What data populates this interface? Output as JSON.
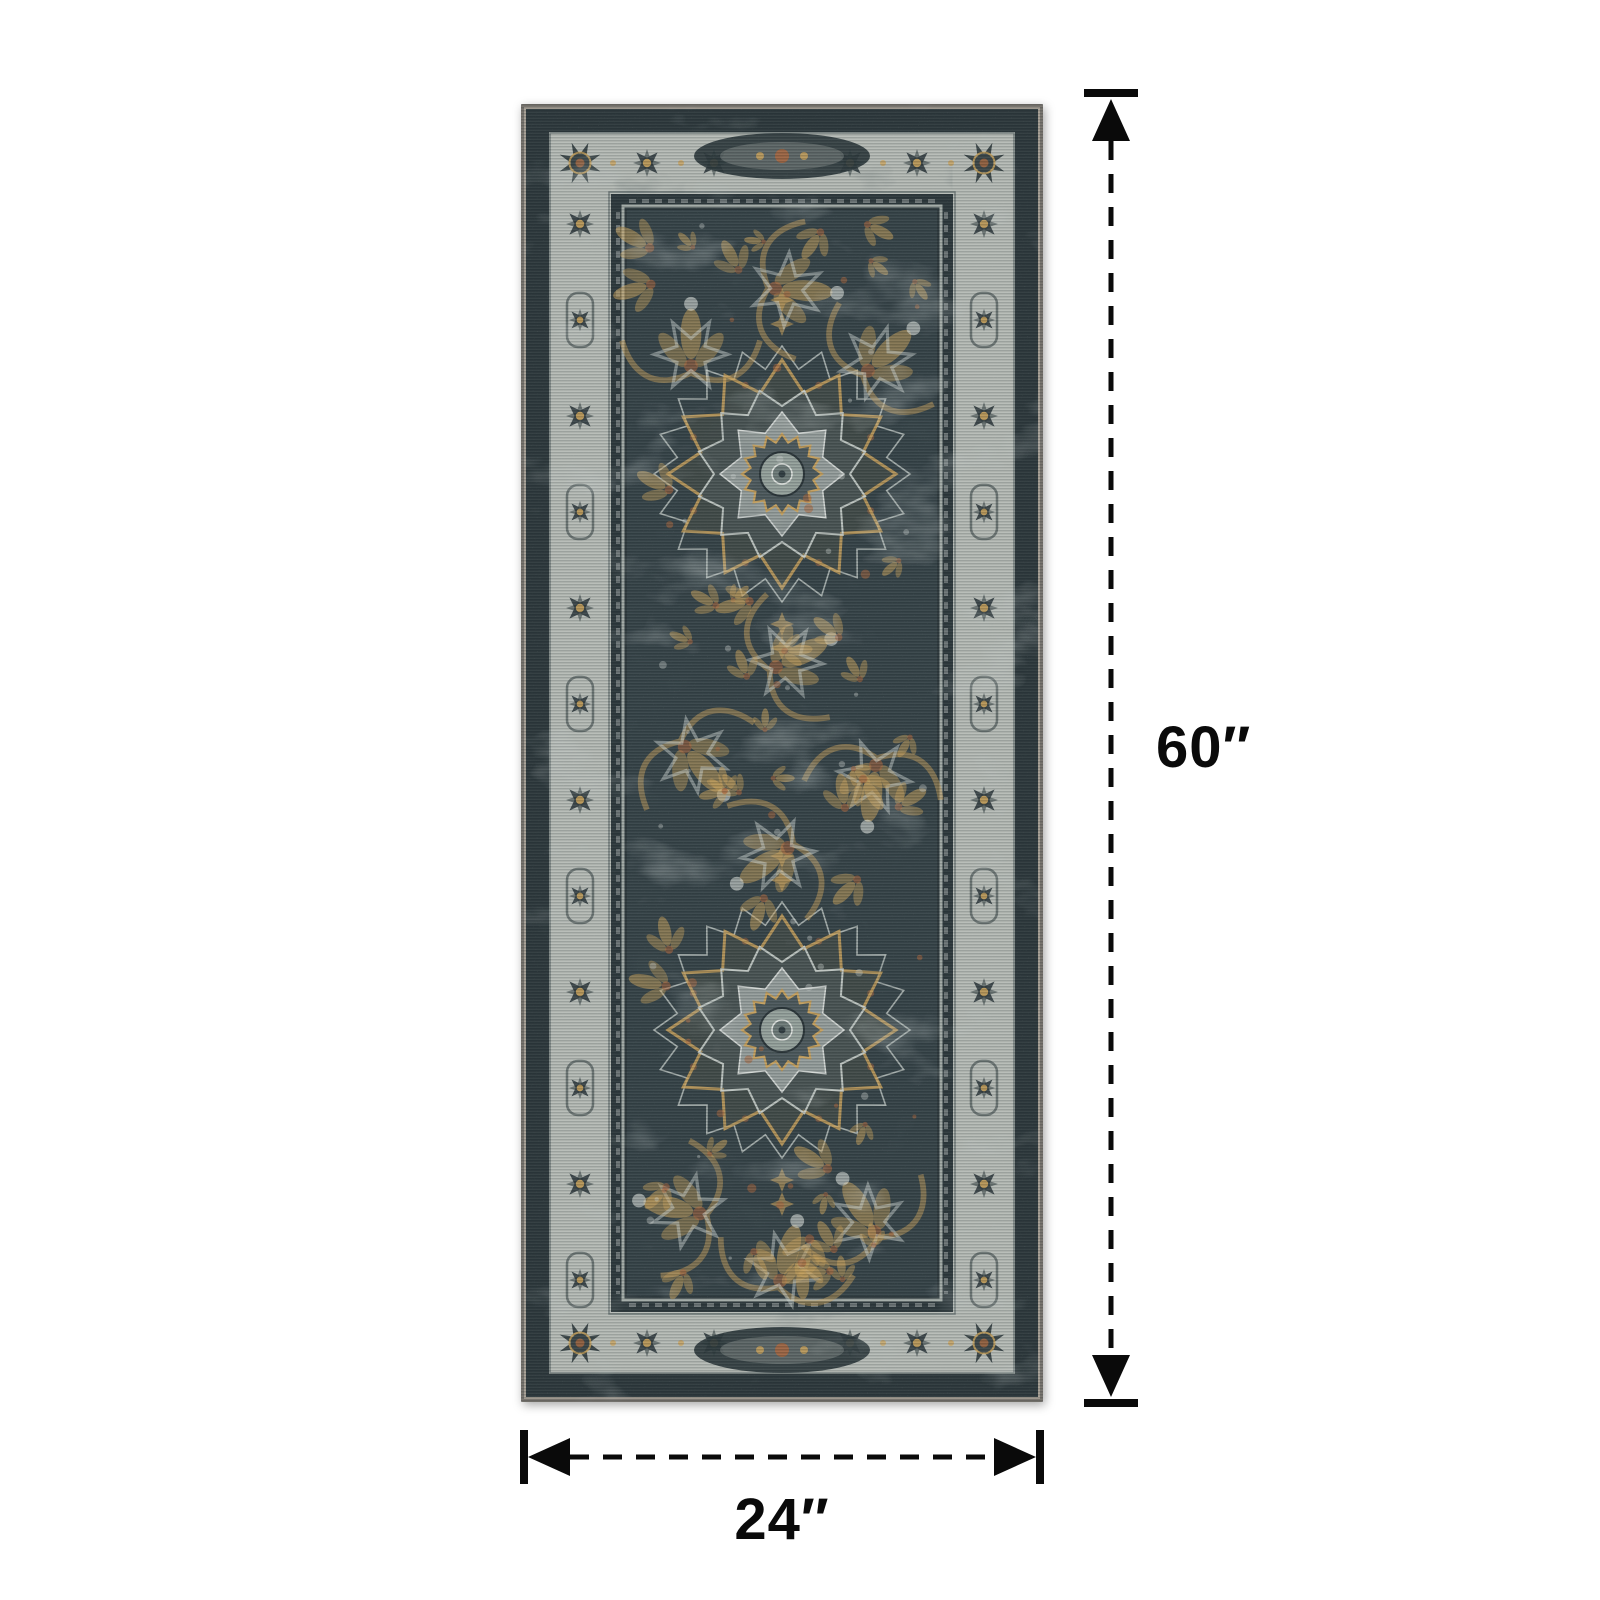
{
  "page": {
    "background": "#ffffff"
  },
  "rug": {
    "palette": {
      "binding": "#a8a096",
      "border_dark": "#2d383c",
      "border_light": "#b7bcb7",
      "pinstripe": "#a2aaa6",
      "field": "#364348",
      "field_light": "#5d6b6e",
      "gold": "#c9a25c",
      "rust": "#a9663e",
      "outline_light": "#ccd3cf"
    }
  },
  "annotations": {
    "color": "#0a0a0a",
    "height_label": "60″",
    "width_label": "24″"
  }
}
